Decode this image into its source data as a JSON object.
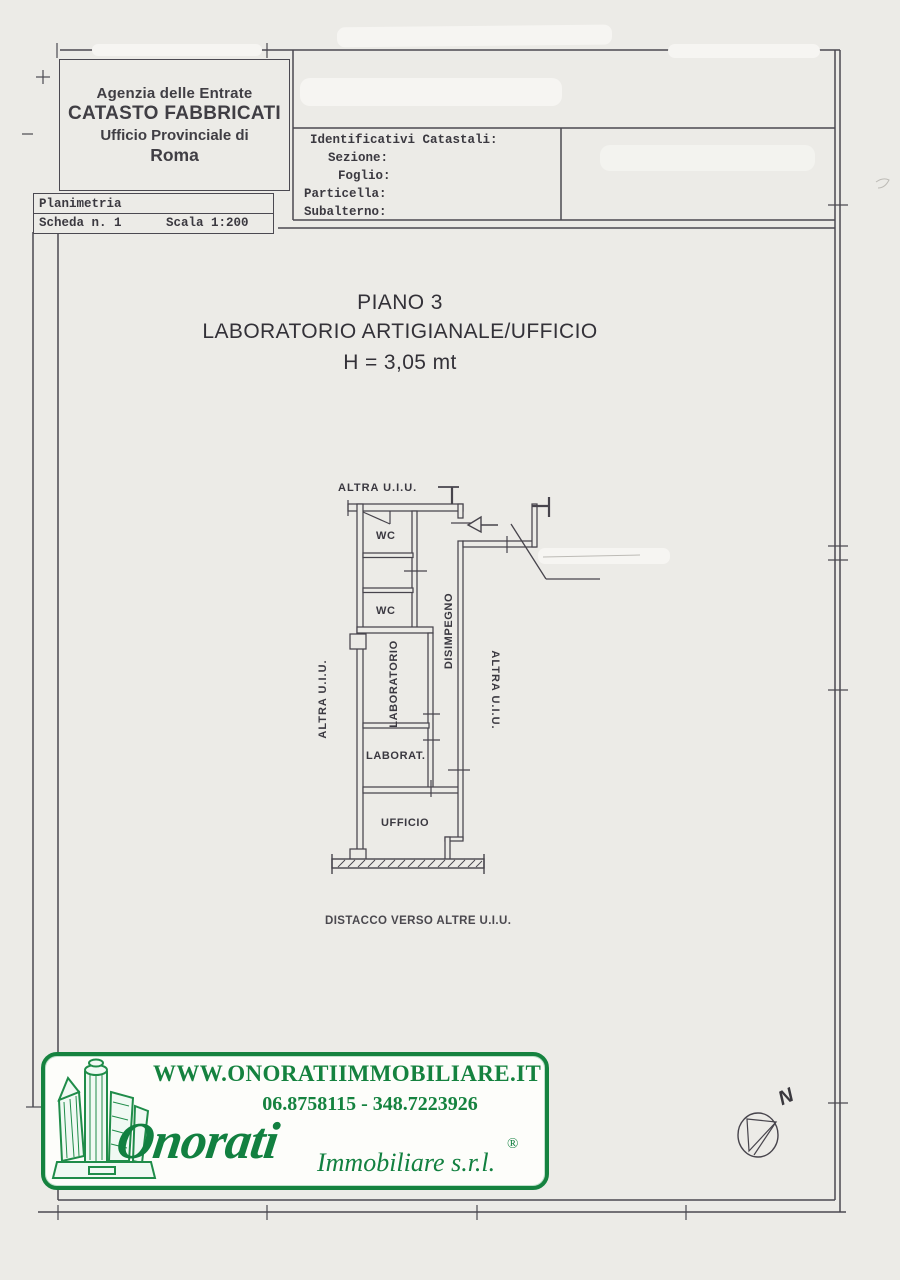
{
  "header": {
    "agency_line1": "Agenzia delle Entrate",
    "agency_line2": "CATASTO FABBRICATI",
    "agency_line3": "Ufficio Provinciale di",
    "agency_line4": "Roma"
  },
  "planimetria": {
    "title": "Planimetria",
    "sheet": "Scheda n. 1",
    "scale": "Scala 1:200"
  },
  "identificativi": {
    "title": "Identificativi Catastali:",
    "fields": [
      "Sezione:",
      "Foglio:",
      "Particella:",
      "Subalterno:"
    ]
  },
  "floor": {
    "piano": "PIANO 3",
    "type": "LABORATORIO ARTIGIANALE/UFFICIO",
    "height": "H = 3,05 mt"
  },
  "plan": {
    "altra_top": "ALTRA U.I.U.",
    "altra_left": "ALTRA U.I.U.",
    "altra_right": "ALTRA U.I.U.",
    "wc_top": "WC",
    "wc_bottom": "WC",
    "disimpegno": "DISIMPEGNO",
    "laboratorio": "LABORATORIO",
    "laborat": "LABORAT.",
    "ufficio": "UFFICIO",
    "caption": "DISTACCO VERSO ALTRE U.I.U."
  },
  "footer": {
    "website": "WWW.ONORATIIMMOBILIARE.IT",
    "phone": "06.8758115 - 348.7223926",
    "brand_script": "Onorati",
    "brand_suffix": "Immobiliare s.r.l.",
    "registered": "®"
  },
  "compass": {
    "label": "N"
  },
  "colors": {
    "brand_green": "#15823f",
    "ink": "#4b4951",
    "paper": "#ecebe7"
  }
}
